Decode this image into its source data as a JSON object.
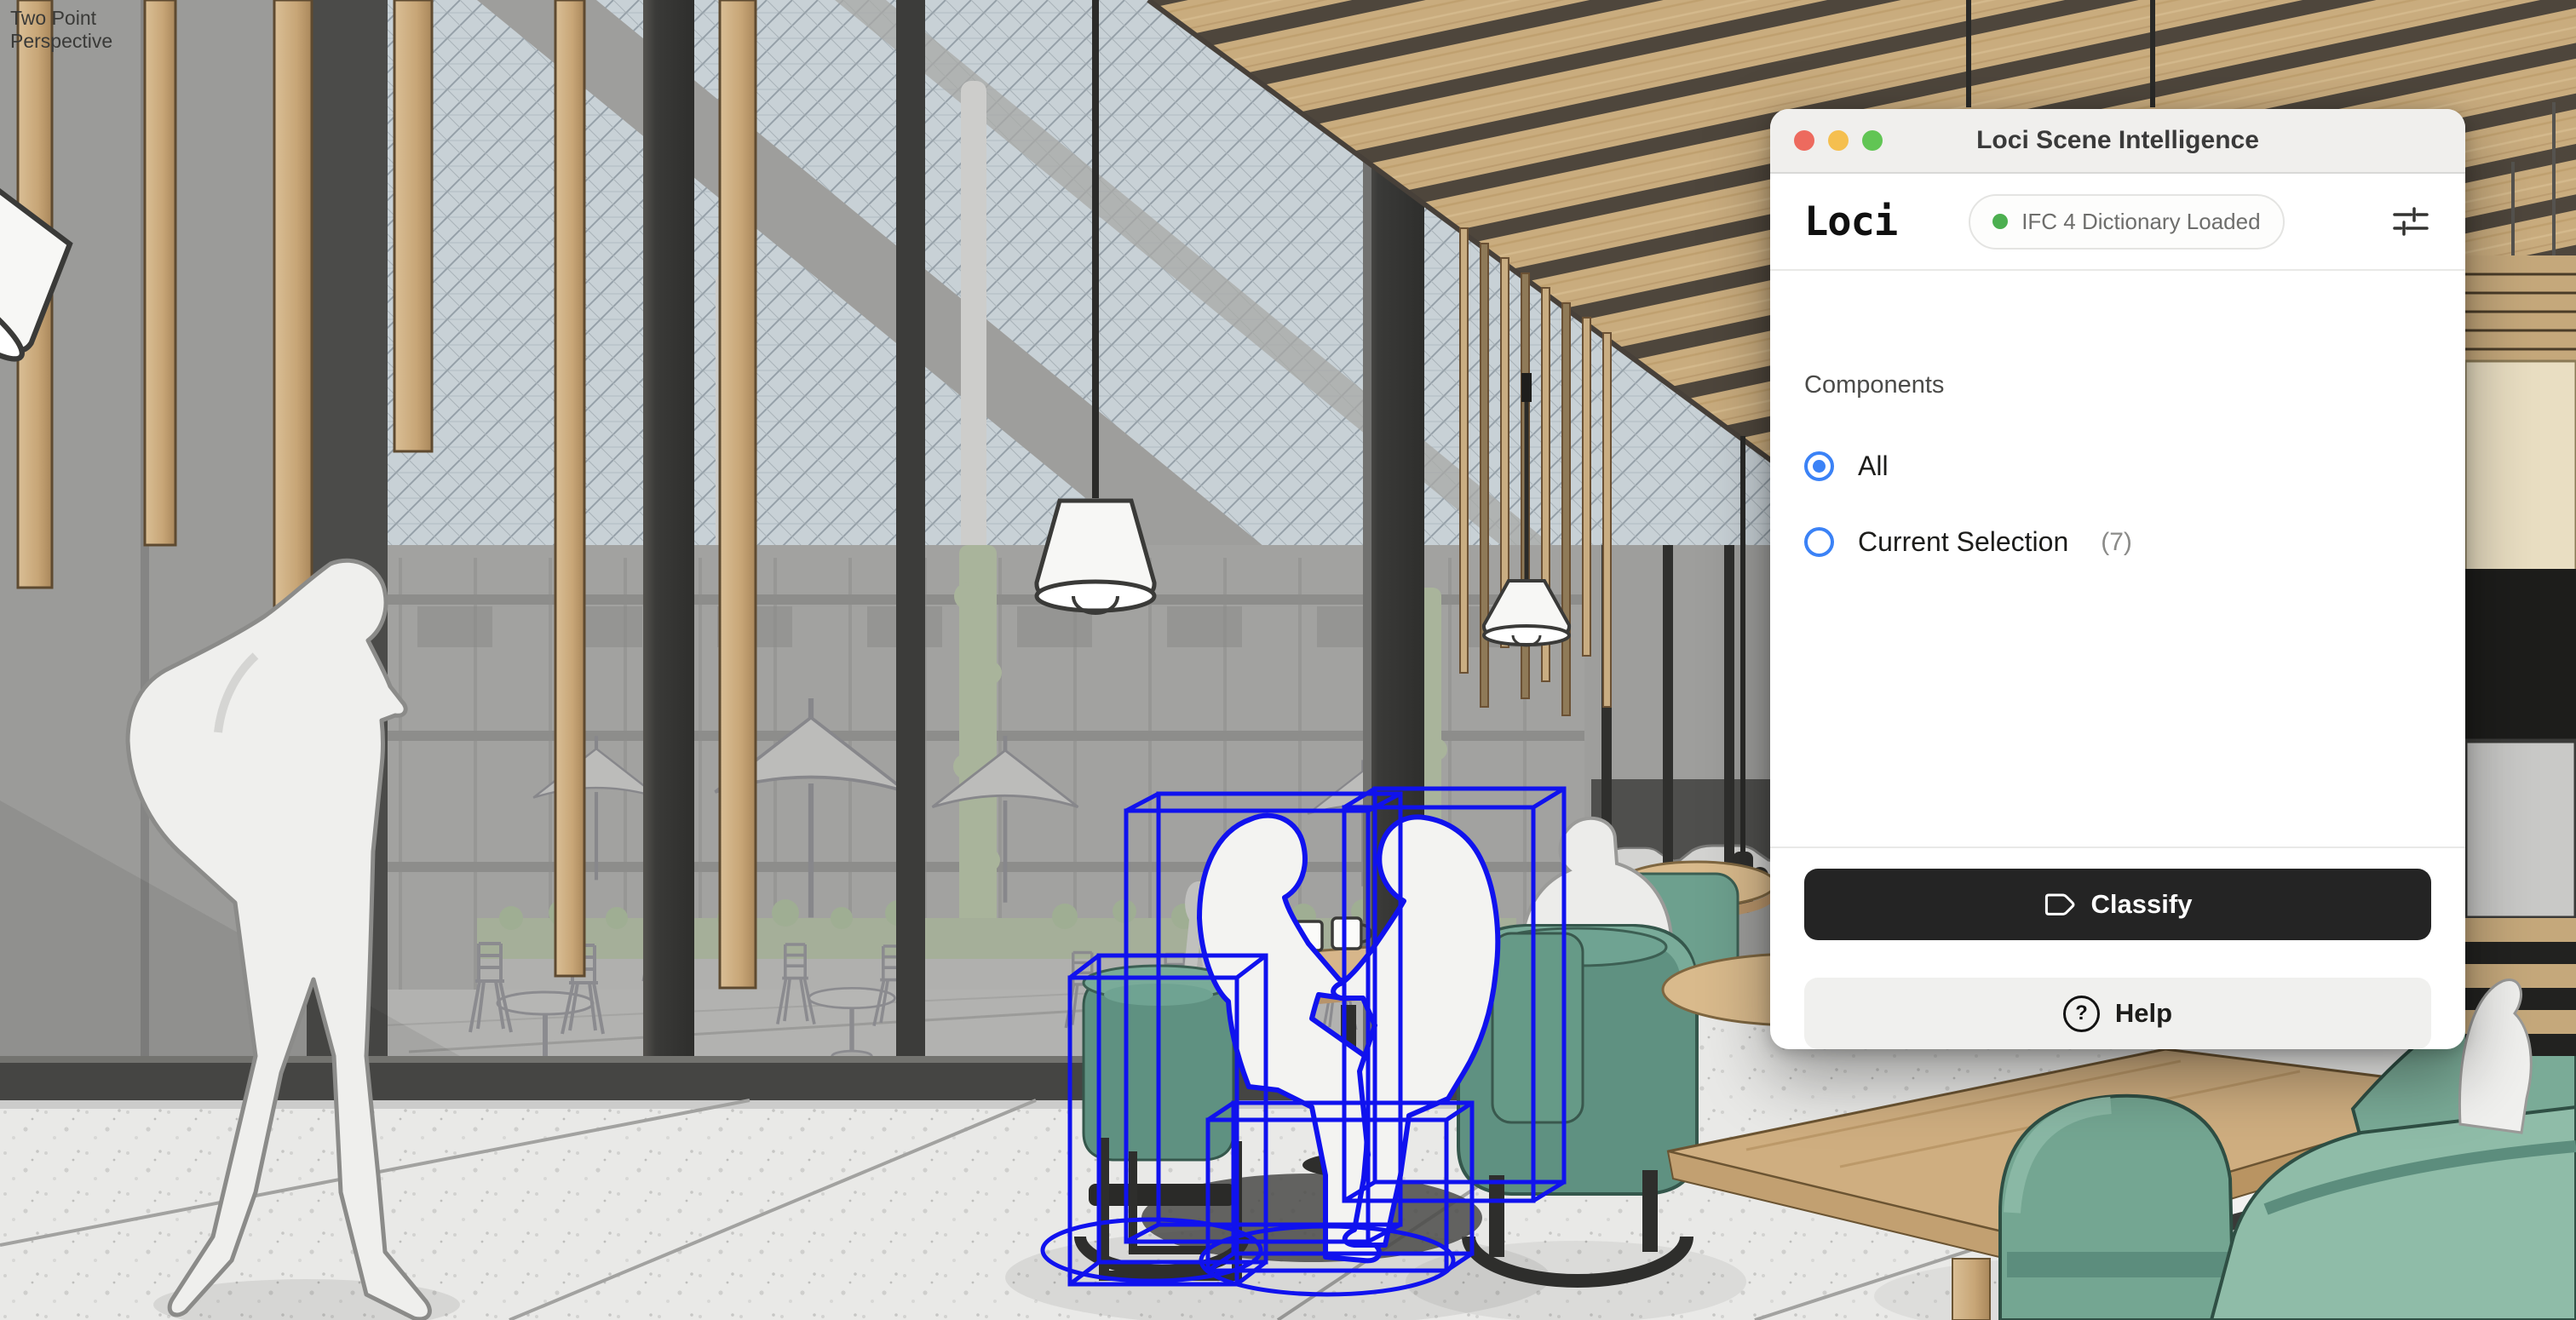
{
  "viewport": {
    "scene_label_line1": "Two Point",
    "scene_label_line2": "Perspective"
  },
  "window": {
    "title": "Loci Scene Intelligence",
    "logo": "Loci",
    "status_badge": {
      "text": "IFC 4 Dictionary Loaded",
      "dot_color": "#4caf50"
    },
    "components": {
      "label": "Components",
      "options": [
        {
          "label": "All",
          "selected": true
        },
        {
          "label": "Current Selection",
          "count": "(7)",
          "selected": false
        }
      ]
    },
    "actions": {
      "classify": "Classify",
      "help": "Help",
      "help_glyph": "?"
    },
    "colors": {
      "accent_blue": "#3b82f6",
      "classify_bg": "#242424",
      "titlebar_bg": "#f0efed",
      "panel_bg": "#ffffff",
      "traffic_close": "#ed6a5e",
      "traffic_minimize": "#f5bf4f",
      "traffic_zoom": "#61c554"
    }
  },
  "scene": {
    "selection_color": "#1012ee",
    "selection_count": 7,
    "palette": {
      "chair_green": "#6fa18f",
      "chair_green_dark": "#5f9181",
      "wood": "#c9ac7e",
      "wood_table": "#cfae80",
      "glass_view_gray": "#a8a8a6",
      "gridshell": "#c8d1d6",
      "floor": "#e9e9e7",
      "mullion_dark": "#3c3c3a",
      "silhouette": "#efefed"
    }
  }
}
